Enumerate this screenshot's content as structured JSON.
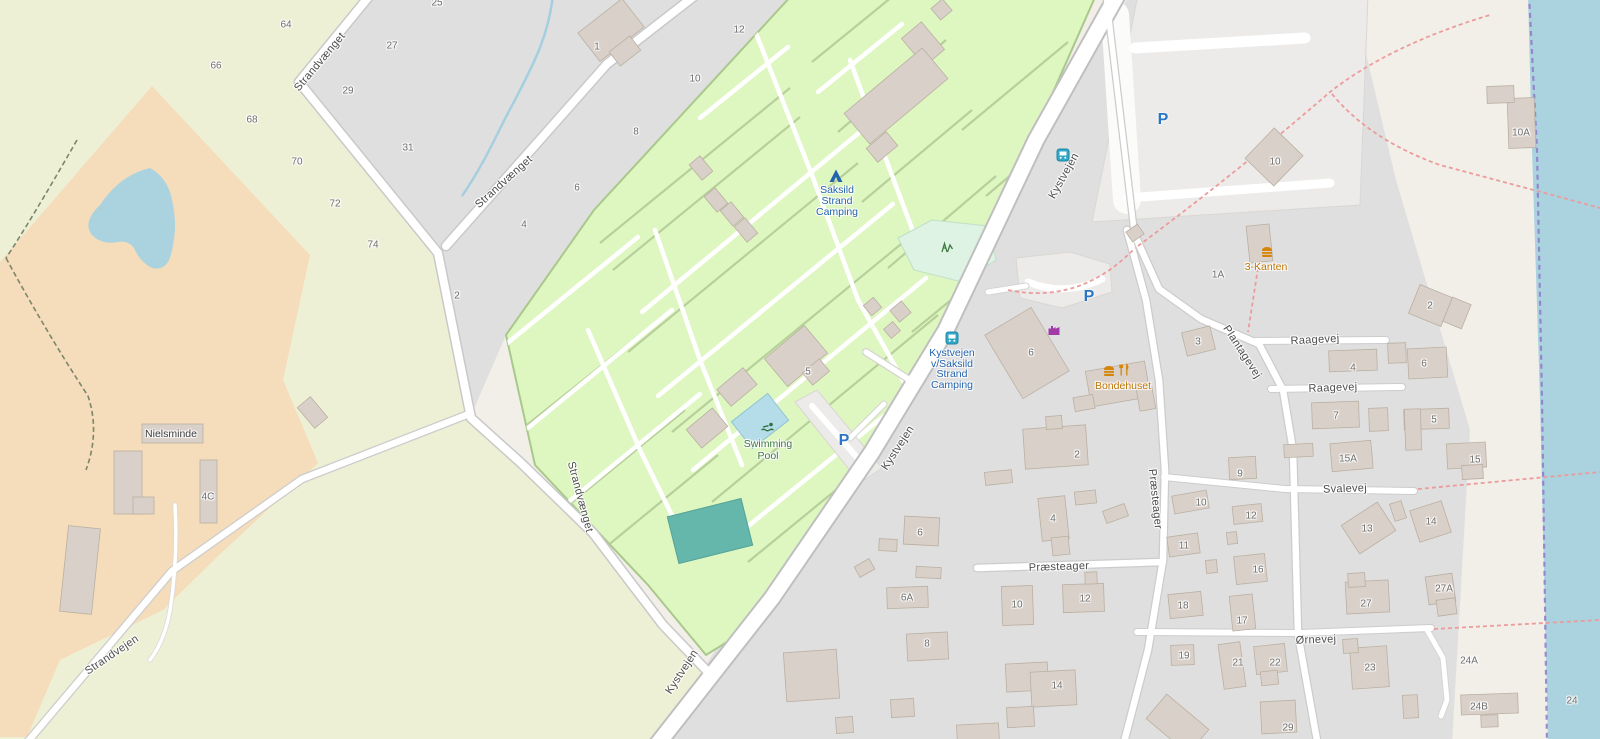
{
  "map": {
    "app": "web-map-viewport",
    "colors": {
      "land": "#f2efe9",
      "field": "#eef0d5",
      "farmyard": "#f5dcba",
      "residential": "#e0dfdf",
      "campground": "#def6c0",
      "water": "#aad3df",
      "road_fill": "#ffffff",
      "building": "#d9d0c9",
      "street_label": "#4c4c4c",
      "house_number": "#6e6e6e",
      "tourism": "#2464ad",
      "transport": "#2464ad",
      "leisure": "#3c7a3f",
      "food": "#bf7405",
      "place": "#3d3d3d",
      "parking": "#2a75c5",
      "path_dashed": "#ec9b9b",
      "boundary": "#8f79c9"
    },
    "labels": {
      "streets": [
        {
          "text": "Strandvænget",
          "x": 320,
          "y": 62,
          "rot": -50
        },
        {
          "text": "Strandvænget",
          "x": 504,
          "y": 182,
          "rot": -42
        },
        {
          "text": "Strandvænget",
          "x": 580,
          "y": 497,
          "rot": 75
        },
        {
          "text": "Kystvejen",
          "x": 1064,
          "y": 176,
          "rot": -61
        },
        {
          "text": "Kystvejen",
          "x": 898,
          "y": 448,
          "rot": -57
        },
        {
          "text": "Kystvejen",
          "x": 682,
          "y": 672,
          "rot": -57
        },
        {
          "text": "Strandvejen",
          "x": 112,
          "y": 655,
          "rot": -34
        },
        {
          "text": "Præsteager",
          "x": 1059,
          "y": 567,
          "rot": -2
        },
        {
          "text": "Præsteager",
          "x": 1155,
          "y": 499,
          "rot": 84
        },
        {
          "text": "Plantagevej",
          "x": 1242,
          "y": 352,
          "rot": 57
        },
        {
          "text": "Raagevej",
          "x": 1315,
          "y": 340,
          "rot": -3
        },
        {
          "text": "Raagevej",
          "x": 1333,
          "y": 388,
          "rot": -2
        },
        {
          "text": "Svalevej",
          "x": 1345,
          "y": 489,
          "rot": -2
        },
        {
          "text": "Ørnevej",
          "x": 1316,
          "y": 640,
          "rot": -2
        }
      ],
      "house_numbers": [
        {
          "text": "64",
          "x": 286,
          "y": 25
        },
        {
          "text": "27",
          "x": 392,
          "y": 46
        },
        {
          "text": "29",
          "x": 348,
          "y": 91
        },
        {
          "text": "31",
          "x": 408,
          "y": 148
        },
        {
          "text": "66",
          "x": 216,
          "y": 66
        },
        {
          "text": "68",
          "x": 252,
          "y": 120
        },
        {
          "text": "70",
          "x": 297,
          "y": 162
        },
        {
          "text": "72",
          "x": 335,
          "y": 204
        },
        {
          "text": "74",
          "x": 373,
          "y": 245
        },
        {
          "text": "25",
          "x": 437,
          "y": 3
        },
        {
          "text": "1",
          "x": 597,
          "y": 47
        },
        {
          "text": "12",
          "x": 739,
          "y": 30
        },
        {
          "text": "10",
          "x": 695,
          "y": 79
        },
        {
          "text": "8",
          "x": 636,
          "y": 132
        },
        {
          "text": "6",
          "x": 577,
          "y": 188
        },
        {
          "text": "4",
          "x": 524,
          "y": 225
        },
        {
          "text": "2",
          "x": 457,
          "y": 296
        },
        {
          "text": "4C",
          "x": 208,
          "y": 497
        },
        {
          "text": "5",
          "x": 808,
          "y": 372
        },
        {
          "text": "6",
          "x": 1031,
          "y": 353
        },
        {
          "text": "3",
          "x": 1198,
          "y": 342
        },
        {
          "text": "1A",
          "x": 1218,
          "y": 275
        },
        {
          "text": "2",
          "x": 1077,
          "y": 455
        },
        {
          "text": "4",
          "x": 1053,
          "y": 519
        },
        {
          "text": "6",
          "x": 920,
          "y": 533
        },
        {
          "text": "6A",
          "x": 907,
          "y": 598
        },
        {
          "text": "10",
          "x": 1017,
          "y": 605
        },
        {
          "text": "12",
          "x": 1085,
          "y": 599
        },
        {
          "text": "8",
          "x": 927,
          "y": 644
        },
        {
          "text": "14",
          "x": 1057,
          "y": 686
        },
        {
          "text": "10",
          "x": 1201,
          "y": 503
        },
        {
          "text": "12",
          "x": 1251,
          "y": 516
        },
        {
          "text": "11",
          "x": 1184,
          "y": 546
        },
        {
          "text": "16",
          "x": 1258,
          "y": 570
        },
        {
          "text": "18",
          "x": 1183,
          "y": 606
        },
        {
          "text": "17",
          "x": 1242,
          "y": 621
        },
        {
          "text": "19",
          "x": 1184,
          "y": 656
        },
        {
          "text": "21",
          "x": 1238,
          "y": 663
        },
        {
          "text": "22",
          "x": 1275,
          "y": 663
        },
        {
          "text": "23",
          "x": 1370,
          "y": 668
        },
        {
          "text": "13",
          "x": 1367,
          "y": 529
        },
        {
          "text": "14",
          "x": 1431,
          "y": 522
        },
        {
          "text": "27",
          "x": 1366,
          "y": 604
        },
        {
          "text": "27A",
          "x": 1444,
          "y": 589
        },
        {
          "text": "24A",
          "x": 1469,
          "y": 661
        },
        {
          "text": "24B",
          "x": 1479,
          "y": 707
        },
        {
          "text": "24",
          "x": 1572,
          "y": 701
        },
        {
          "text": "29",
          "x": 1288,
          "y": 728
        },
        {
          "text": "2",
          "x": 1430,
          "y": 306
        },
        {
          "text": "4",
          "x": 1353,
          "y": 368
        },
        {
          "text": "6",
          "x": 1424,
          "y": 364
        },
        {
          "text": "7",
          "x": 1336,
          "y": 416
        },
        {
          "text": "5",
          "x": 1434,
          "y": 420
        },
        {
          "text": "15A",
          "x": 1348,
          "y": 459
        },
        {
          "text": "15",
          "x": 1475,
          "y": 460
        },
        {
          "text": "9",
          "x": 1240,
          "y": 474
        },
        {
          "text": "10",
          "x": 1275,
          "y": 162
        },
        {
          "text": "10A",
          "x": 1521,
          "y": 133
        }
      ],
      "pois": [
        {
          "lines": [
            "Saksild",
            "Strand",
            "Camping"
          ],
          "x": 837,
          "y": 190,
          "lh": 11,
          "type": "tourism"
        },
        {
          "lines": [
            "Kystvejen",
            "v/Saksild",
            "Strand",
            "Camping"
          ],
          "x": 952,
          "y": 353,
          "lh": 10.5,
          "type": "transport"
        },
        {
          "lines": [
            "Swimming",
            "Pool"
          ],
          "x": 768,
          "y": 444,
          "lh": 11.5,
          "type": "leisure"
        },
        {
          "lines": [
            "Nielsminde"
          ],
          "x": 171,
          "y": 434,
          "lh": 11,
          "type": "place"
        },
        {
          "lines": [
            "Bondehuset"
          ],
          "x": 1123,
          "y": 386,
          "lh": 11,
          "type": "food"
        },
        {
          "lines": [
            "3-Kanten"
          ],
          "x": 1266,
          "y": 267,
          "lh": 11,
          "type": "food"
        }
      ]
    },
    "icons": [
      {
        "name": "tent",
        "x": 836,
        "y": 176
      },
      {
        "name": "bus",
        "x": 952,
        "y": 338
      },
      {
        "name": "bus",
        "x": 1063,
        "y": 155
      },
      {
        "name": "parking",
        "glyph": "P",
        "x": 844,
        "y": 441
      },
      {
        "name": "parking",
        "glyph": "P",
        "x": 1089,
        "y": 297
      },
      {
        "name": "parking",
        "glyph": "P",
        "x": 1163,
        "y": 120
      },
      {
        "name": "burger",
        "x": 1109,
        "y": 371
      },
      {
        "name": "cutlery",
        "x": 1124,
        "y": 370
      },
      {
        "name": "burger",
        "x": 1267,
        "y": 252
      },
      {
        "name": "factory",
        "x": 1054,
        "y": 330
      },
      {
        "name": "playground",
        "x": 947,
        "y": 247
      },
      {
        "name": "swimmer",
        "x": 768,
        "y": 427
      }
    ]
  }
}
